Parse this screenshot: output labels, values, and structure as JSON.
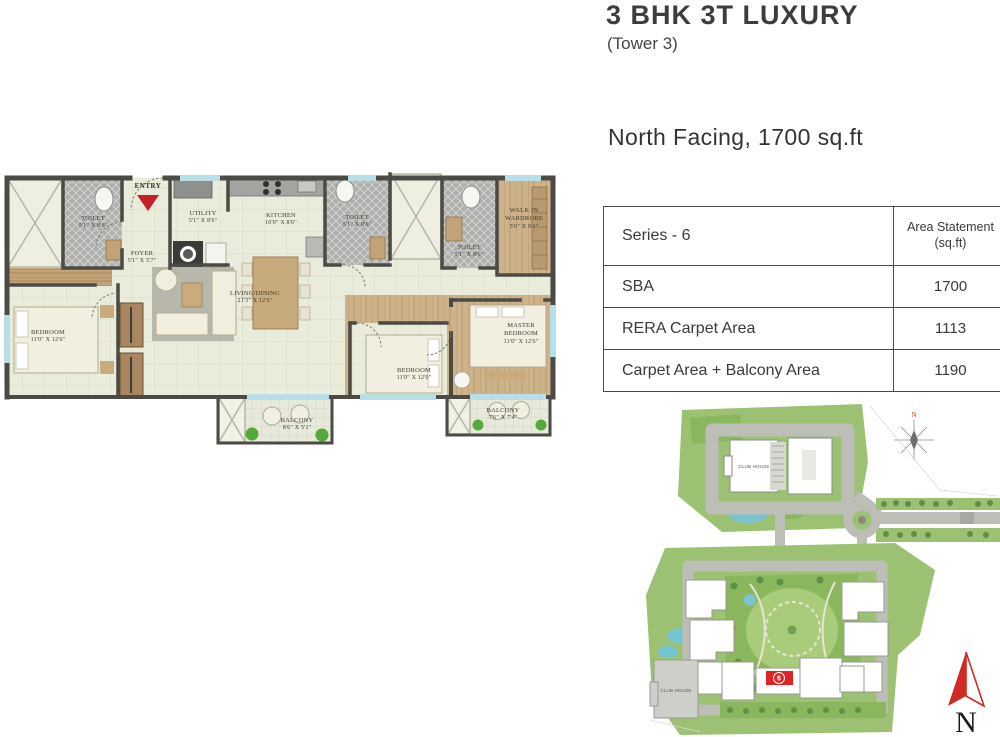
{
  "header": {
    "title": "3 BHK 3T LUXURY",
    "subtitle": "(Tower 3)",
    "facing_line": "North Facing, 1700 sq.ft"
  },
  "area_table": {
    "series_label": "Series - 6",
    "area_col_label": "Area Statement (sq.ft)",
    "rows": [
      {
        "label": "SBA",
        "value": "1700"
      },
      {
        "label": "RERA Carpet Area",
        "value": "1113"
      },
      {
        "label": "Carpet Area + Balcony Area",
        "value": "1190"
      }
    ]
  },
  "floor_plan": {
    "entry_label": "ENTRY",
    "rooms": {
      "toilet1": {
        "name": "TOILET",
        "dims": "5'1\" X 8'6\""
      },
      "foyer": {
        "name": "FOYER",
        "dims": "5'1\" X 5'7\""
      },
      "utility": {
        "name": "UTILITY",
        "dims": "5'1\" X 8'6\""
      },
      "kitchen": {
        "name": "KITCHEN",
        "dims": "10'0\" X 8'6\""
      },
      "toilet2": {
        "name": "TOILET",
        "dims": "5'1\" X 8'6\""
      },
      "toilet3": {
        "name": "TOILET",
        "dims": "5'1\" X 8'6\""
      },
      "walkin_wardrobe": {
        "name": "WALK IN WARDROBE",
        "dims": "5'0\" X 9'1\""
      },
      "bedroom1": {
        "name": "BEDROOM",
        "dims": "11'0\" X 12'6\""
      },
      "living_dining": {
        "name": "LIVING/DINING",
        "dims": "21'3\" X 12'6\""
      },
      "balcony1": {
        "name": "BALCONY",
        "dims": "8'6\" X 5'1\""
      },
      "bedroom2": {
        "name": "BEDROOM",
        "dims": "11'0\" X 12'0\""
      },
      "master_bedroom": {
        "name": "MASTER BEDROOM",
        "dims": "11'0\" X 12'6\""
      },
      "balcony2": {
        "name": "BALCONY",
        "dims": "7'6\" X 7'4\""
      }
    }
  },
  "site_plan": {
    "club_house_top": "CLUB HOUSE",
    "club_house_bottom": "CLUB HOUSE",
    "unit_marker": "6",
    "rose_label": "N"
  },
  "compass": {
    "label": "N"
  },
  "colors": {
    "accent_red": "#c42127",
    "wall": "#4b4a45",
    "floor_cream": "#eaecdb",
    "wood": "#cbb088",
    "site_green": "#9cc173",
    "road_gray": "#bdbfb7",
    "marker_red": "#e02424"
  }
}
